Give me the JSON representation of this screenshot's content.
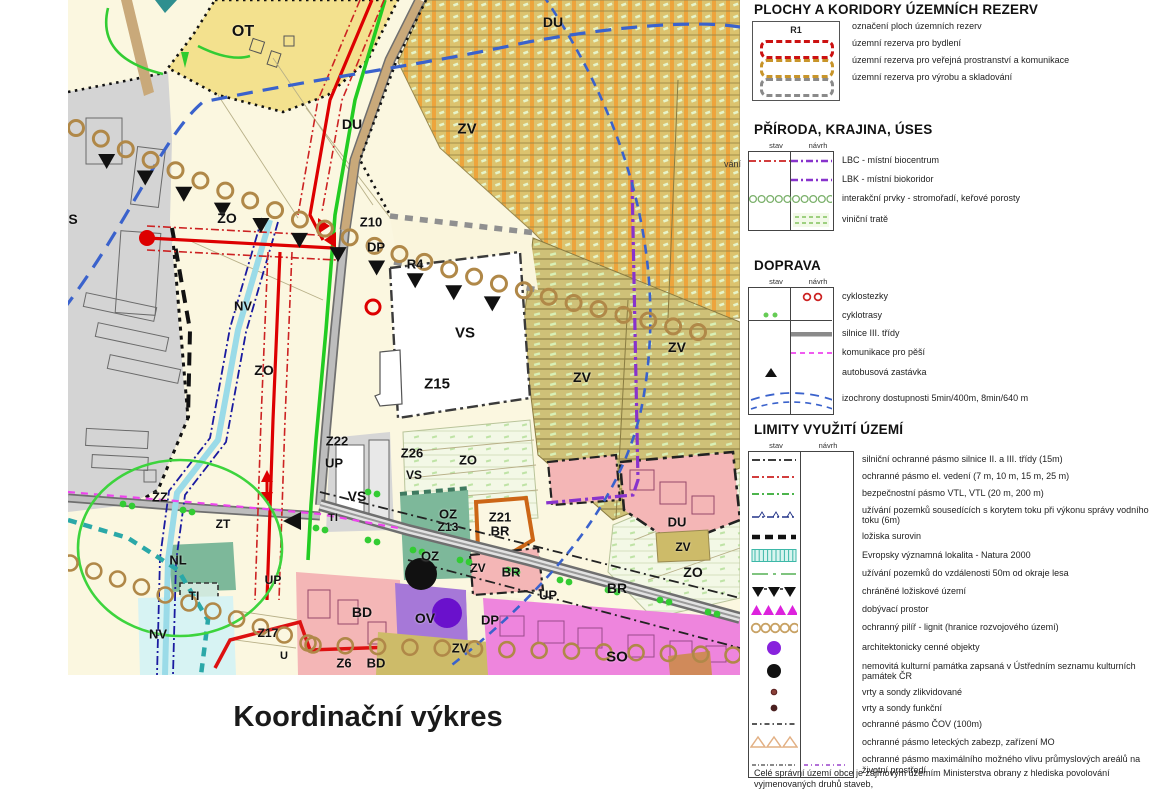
{
  "title": "Koordinační výkres",
  "map": {
    "edge_label": "vání",
    "labels": [
      {
        "t": "OT",
        "x": 175,
        "y": 32,
        "s": 16
      },
      {
        "t": "DU",
        "x": 485,
        "y": 22,
        "s": 14
      },
      {
        "t": "ZV",
        "x": 399,
        "y": 129,
        "s": 15
      },
      {
        "t": "DU",
        "x": 284,
        "y": 124,
        "s": 14
      },
      {
        "t": "Z10",
        "x": 303,
        "y": 222,
        "s": 13
      },
      {
        "t": "DP",
        "x": 308,
        "y": 247,
        "s": 13
      },
      {
        "t": "R4",
        "x": 347,
        "y": 264,
        "s": 13
      },
      {
        "t": "VS",
        "x": 397,
        "y": 333,
        "s": 15
      },
      {
        "t": "Z15",
        "x": 369,
        "y": 384,
        "s": 15
      },
      {
        "t": "ZO",
        "x": 159,
        "y": 218,
        "s": 14
      },
      {
        "t": "S",
        "x": 5,
        "y": 219,
        "s": 14
      },
      {
        "t": "NV",
        "x": 175,
        "y": 306,
        "s": 13
      },
      {
        "t": "ZO",
        "x": 196,
        "y": 370,
        "s": 14
      },
      {
        "t": "ZZ",
        "x": 92,
        "y": 497,
        "s": 13
      },
      {
        "t": "ZT",
        "x": 155,
        "y": 524,
        "s": 12
      },
      {
        "t": "NL",
        "x": 110,
        "y": 560,
        "s": 13
      },
      {
        "t": "TI",
        "x": 126,
        "y": 596,
        "s": 12
      },
      {
        "t": "NV",
        "x": 90,
        "y": 634,
        "s": 13
      },
      {
        "t": "Z22",
        "x": 269,
        "y": 441,
        "s": 13
      },
      {
        "t": "UP",
        "x": 266,
        "y": 463,
        "s": 13
      },
      {
        "t": "Z26",
        "x": 344,
        "y": 453,
        "s": 13
      },
      {
        "t": "VS",
        "x": 346,
        "y": 475,
        "s": 12
      },
      {
        "t": "ZO",
        "x": 400,
        "y": 460,
        "s": 13
      },
      {
        "t": "VS",
        "x": 289,
        "y": 496,
        "s": 14
      },
      {
        "t": "TI",
        "x": 265,
        "y": 518,
        "s": 11
      },
      {
        "t": "UP",
        "x": 205,
        "y": 580,
        "s": 12
      },
      {
        "t": "Z17",
        "x": 200,
        "y": 633,
        "s": 12
      },
      {
        "t": "U",
        "x": 216,
        "y": 656,
        "s": 11
      },
      {
        "t": "BD",
        "x": 294,
        "y": 612,
        "s": 14
      },
      {
        "t": "Z6",
        "x": 276,
        "y": 663,
        "s": 13
      },
      {
        "t": "BD",
        "x": 308,
        "y": 663,
        "s": 13
      },
      {
        "t": "OV",
        "x": 357,
        "y": 618,
        "s": 14
      },
      {
        "t": "DP",
        "x": 422,
        "y": 620,
        "s": 13
      },
      {
        "t": "ZV",
        "x": 392,
        "y": 648,
        "s": 13
      },
      {
        "t": "SO",
        "x": 549,
        "y": 657,
        "s": 15
      },
      {
        "t": "OZ",
        "x": 380,
        "y": 514,
        "s": 13
      },
      {
        "t": "Z13",
        "x": 380,
        "y": 527,
        "s": 12
      },
      {
        "t": "OZ",
        "x": 362,
        "y": 556,
        "s": 13
      },
      {
        "t": "Z21",
        "x": 432,
        "y": 517,
        "s": 13
      },
      {
        "t": "BR",
        "x": 432,
        "y": 531,
        "s": 13
      },
      {
        "t": "ZV",
        "x": 410,
        "y": 568,
        "s": 12
      },
      {
        "t": "BR",
        "x": 443,
        "y": 572,
        "s": 13
      },
      {
        "t": "UP",
        "x": 480,
        "y": 595,
        "s": 13
      },
      {
        "t": "BR",
        "x": 549,
        "y": 588,
        "s": 14
      },
      {
        "t": "ZO",
        "x": 625,
        "y": 572,
        "s": 14
      },
      {
        "t": "ZV",
        "x": 615,
        "y": 547,
        "s": 12
      },
      {
        "t": "DU",
        "x": 609,
        "y": 522,
        "s": 13
      },
      {
        "t": "ZV",
        "x": 514,
        "y": 377,
        "s": 14
      },
      {
        "t": "ZV",
        "x": 609,
        "y": 347,
        "s": 14
      }
    ]
  },
  "legend": {
    "colors": {
      "accent_red": "#cc2222",
      "accent_purple": "#8833cc",
      "accent_green": "#33aa33",
      "accent_magenta": "#dd22dd",
      "accent_teal": "#3db8a8",
      "accent_tan": "#c8a264"
    },
    "sections": [
      {
        "id": "rezervy",
        "title": "PLOCHY A KORIDORY ÚZEMNÍCH REZERV",
        "box_label": "R1",
        "items": [
          {
            "label": "označení ploch územních rezerv"
          },
          {
            "label": "územní rezerva pro bydlení"
          },
          {
            "label": "územní rezerva pro veřejná prostranství a komunikace"
          },
          {
            "label": "územní rezerva pro výrobu a skladování"
          }
        ]
      },
      {
        "id": "priroda",
        "title": "PŘÍRODA, KRAJINA, ÚSES",
        "col1": "stav",
        "col2": "návrh",
        "items": [
          {
            "label": "LBC - místní biocentrum",
            "stav": "red-dashdot",
            "navrh": "purple-dashdot"
          },
          {
            "label": "LBK - místní biokoridor",
            "navrh": "purple-dashdot"
          },
          {
            "label": "interakční prvky - stromořadí, keřové porosty",
            "span": "green-circles"
          },
          {
            "label": "viniční tratě",
            "navrh": "green-hatch-box"
          }
        ]
      },
      {
        "id": "doprava",
        "title": "DOPRAVA",
        "col1": "stav",
        "col2": "návrh",
        "items": [
          {
            "label": "cyklostezky",
            "navrh": "red-circles"
          },
          {
            "label": "cyklotrasy",
            "stav": "green-dots",
            "hr": true
          },
          {
            "label": "silnice III. třídy",
            "navrh": "gray-bar"
          },
          {
            "label": "komunikace pro pěší",
            "navrh": "magenta-dash"
          },
          {
            "label": "autobusová zastávka",
            "stav": "bus-triangle"
          },
          {
            "label": "izochrony dostupnosti 5min/400m, 8min/640 m",
            "span": "blue-arcs"
          }
        ]
      },
      {
        "id": "limity",
        "title": "LIMITY VYUŽITÍ ÚZEMÍ",
        "col1": "stav",
        "col2": "návrh",
        "items": [
          {
            "label": "silniční ochranné pásmo silnice II. a III. třídy (15m)",
            "stav": "black-dashdot"
          },
          {
            "label": "ochranné pásmo el. vedení (7 m, 10 m, 15 m, 25 m)",
            "stav": "red-dashdot"
          },
          {
            "label": "bezpečnostní pásmo VTL, VTL (20 m, 200 m)",
            "stav": "green-dashdot"
          },
          {
            "label": "užívání pozemků sousedících s korytem toku při výkonu správy vodního toku (6m)",
            "stav": "navy-dashdot-ticks"
          },
          {
            "label": "ložiska surovin",
            "stav": "black-thick-dash"
          },
          {
            "label": "Evropsky významná lokalita - Natura 2000",
            "stav": "teal-hatch-bar"
          },
          {
            "label": "užívání pozemků do vzdálenosti 50m od okraje lesa",
            "stav": "green-line-gap"
          },
          {
            "label": "chráněné ložiskové území",
            "stav": "black-triangles-down"
          },
          {
            "label": "dobývací prostor",
            "stav": "magenta-triangles-up"
          },
          {
            "label": "ochranný pilíř - lignit (hranice rozvojového území)",
            "stav": "tan-circles"
          },
          {
            "label": "architektonicky cenné objekty",
            "stav": "purple-dot-large"
          },
          {
            "label": "nemovitá kulturní památka zapsaná v Ústředním seznamu kulturních památek ČR",
            "stav": "black-dot-large"
          },
          {
            "label": "vrty a sondy zlikvidované",
            "stav": "brown-dot-small"
          },
          {
            "label": "vrty a sondy funkční",
            "stav": "brown-dot-med"
          },
          {
            "label": "ochranné pásmo ČOV (100m)",
            "stav": "black-dashdot-fine"
          },
          {
            "label": "ochranné pásmo leteckých zabezp, zařízení MO",
            "stav": "tan-triangles-open"
          },
          {
            "label": "ochranné pásmo maximálního možného vlivu průmyslových areálů na životní prostředí",
            "stav": "dark-dashdot",
            "navrh": "purple-dash-fine"
          }
        ]
      }
    ],
    "footer": "Celé správní území obce je zájmovým územím Ministerstva obrany z hlediska povolování vyjmenovaných druhů staveb,"
  }
}
